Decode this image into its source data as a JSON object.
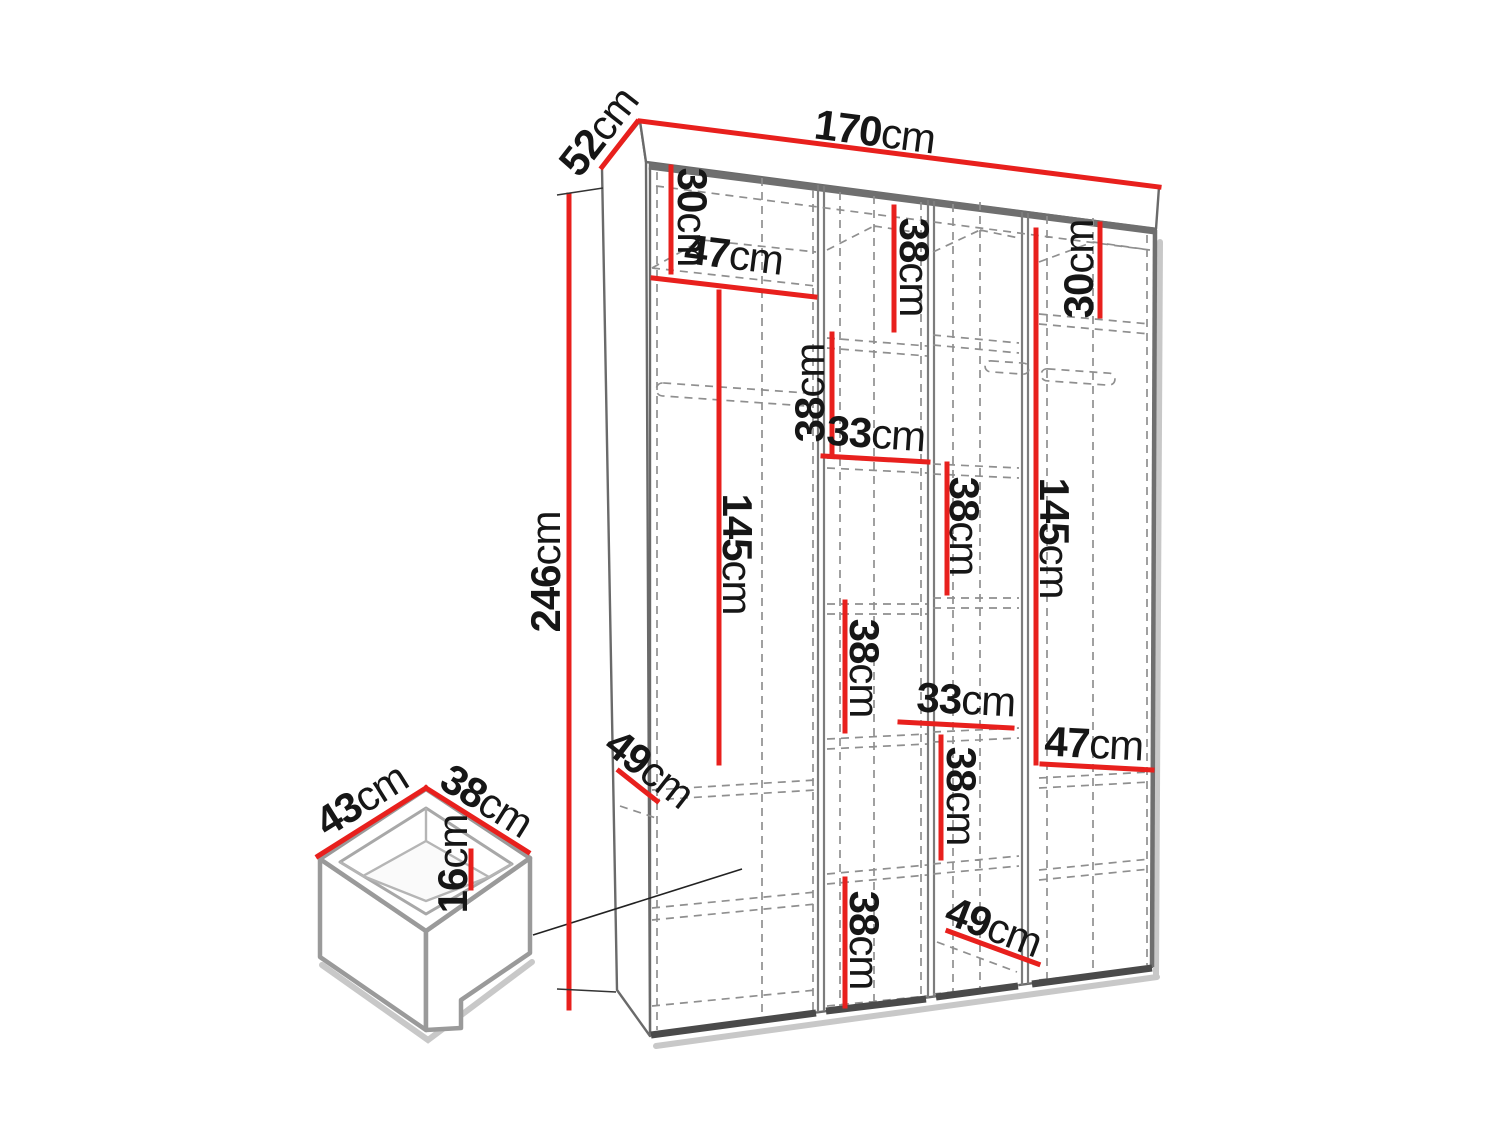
{
  "figure": {
    "kind": "furniture-dimension-diagram",
    "subject": "wardrobe-with-drawer-detail"
  },
  "dims": {
    "width": {
      "value": "170",
      "unit": "cm"
    },
    "depth": {
      "value": "52",
      "unit": "cm"
    },
    "height": {
      "value": "246",
      "unit": "cm"
    },
    "left_top_height": {
      "value": "30",
      "unit": "cm"
    },
    "left_width": {
      "value": "47",
      "unit": "cm"
    },
    "left_hanging_height": {
      "value": "145",
      "unit": "cm"
    },
    "left_bottom_depth": {
      "value": "49",
      "unit": "cm"
    },
    "mid_upper_height": {
      "value": "38",
      "unit": "cm"
    },
    "mid_width_upper": {
      "value": "33",
      "unit": "cm"
    },
    "midright_top_height": {
      "value": "38",
      "unit": "cm"
    },
    "midright_upper_height": {
      "value": "38",
      "unit": "cm"
    },
    "mid_middle_height": {
      "value": "38",
      "unit": "cm"
    },
    "midright_width_lower": {
      "value": "33",
      "unit": "cm"
    },
    "midright_lower_height": {
      "value": "38",
      "unit": "cm"
    },
    "right_width": {
      "value": "47",
      "unit": "cm"
    },
    "right_hanging_height": {
      "value": "145",
      "unit": "cm"
    },
    "right_top_height": {
      "value": "30",
      "unit": "cm"
    },
    "mid_bottom_height": {
      "value": "38",
      "unit": "cm"
    },
    "right_bottom_depth": {
      "value": "49",
      "unit": "cm"
    }
  },
  "drawer": {
    "width": {
      "value": "43",
      "unit": "cm"
    },
    "depth": {
      "value": "38",
      "unit": "cm"
    },
    "height": {
      "value": "16",
      "unit": "cm"
    }
  },
  "colors": {
    "dimension_red": "#e8201d",
    "outline_gray": "#6a6a6a",
    "dash_gray": "#8f8f8f",
    "shadow_gray": "#c8c8c8",
    "label_black": "#161616"
  }
}
